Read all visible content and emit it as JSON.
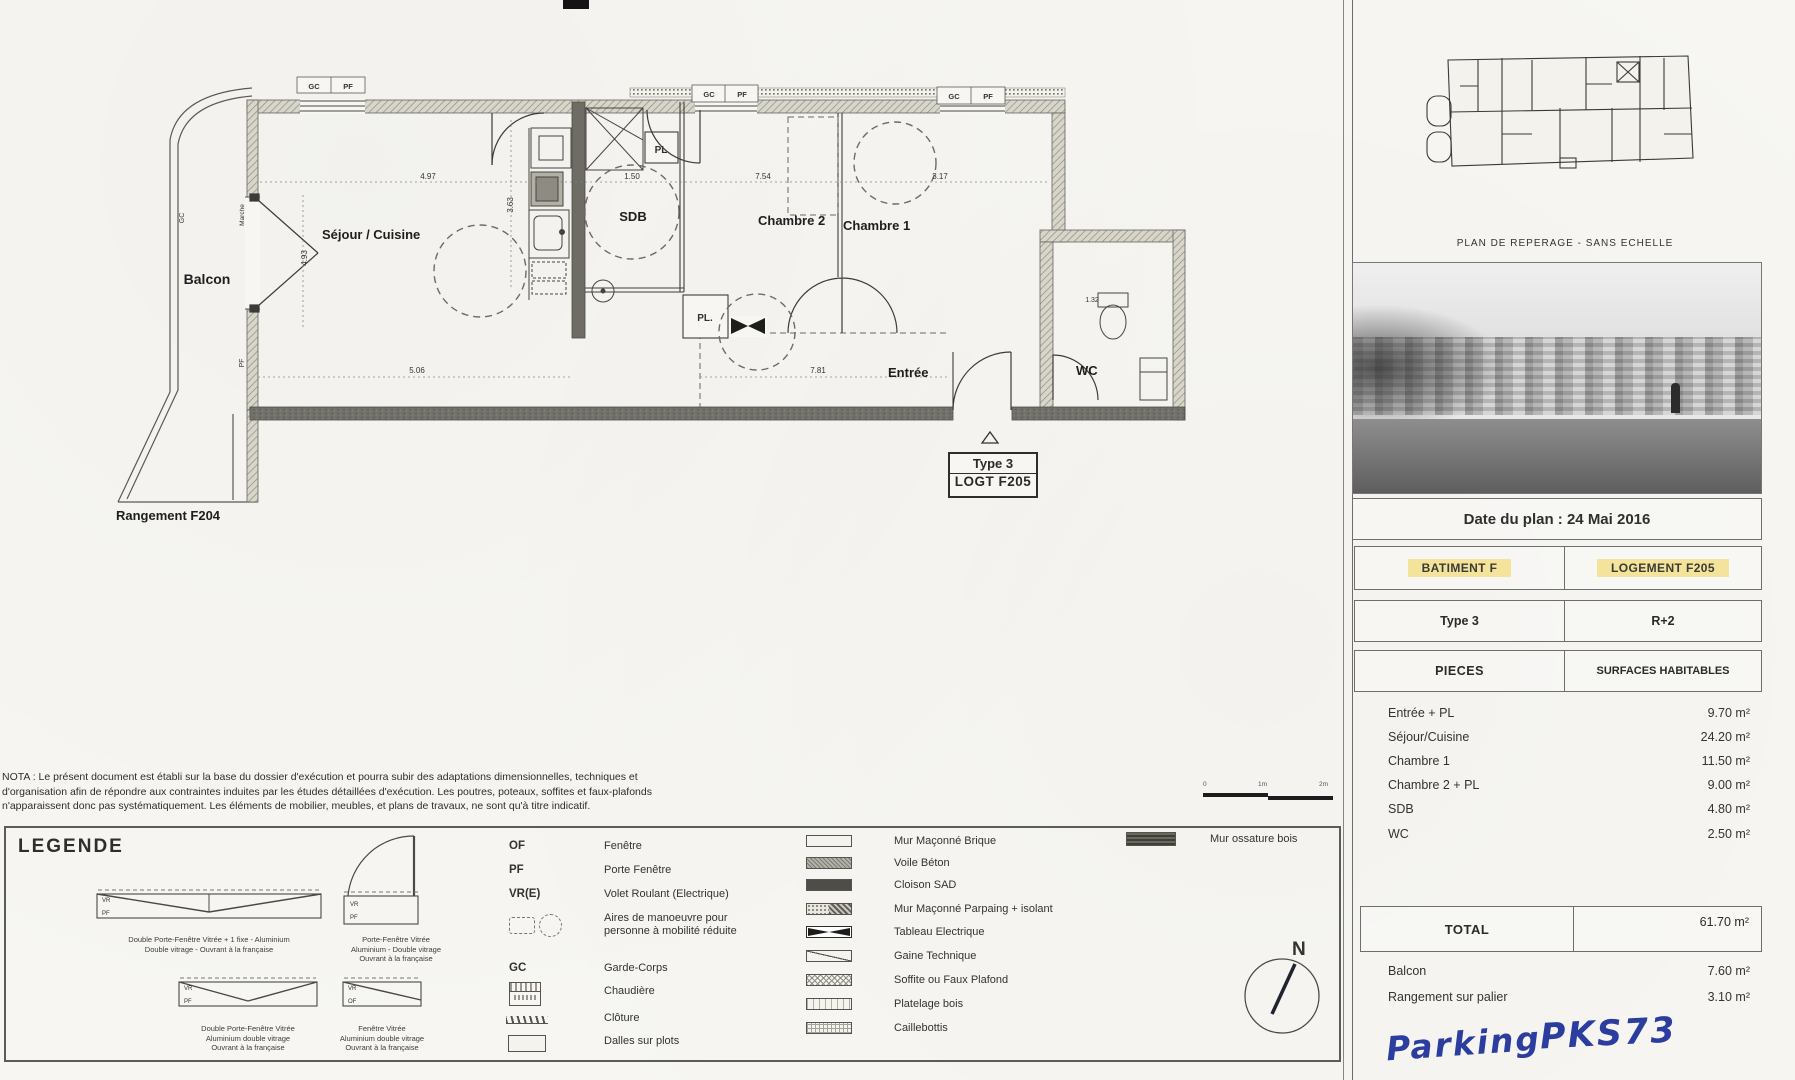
{
  "plan": {
    "labels": {
      "balcon": "Balcon",
      "sejour": "Séjour / Cuisine",
      "sdb": "SDB",
      "chambre2": "Chambre 2",
      "chambre1": "Chambre 1",
      "entree": "Entrée",
      "wc": "WC",
      "rangement": "Rangement F204",
      "pl_top": "PL",
      "pl_bottom": "PL.",
      "marche": "Marche",
      "gc_balcony": "GC",
      "pf_balcony": "PF"
    },
    "tag": {
      "type": "Type 3",
      "logt": "LOGT F205"
    },
    "window_labels": {
      "gc": "GC",
      "pf": "PF"
    },
    "dims": {
      "d_497": "4.97",
      "d_150": "1.50",
      "d_754": "7.54",
      "d_317": "3.17",
      "d_493": "4.93",
      "d_363": "3.63",
      "d_506": "5.06",
      "d_781": "7.81",
      "d_132": "1.32"
    }
  },
  "key_plan": {
    "caption": "PLAN DE REPERAGE - SANS ECHELLE"
  },
  "info": {
    "date": "Date du plan : 24 Mai 2016",
    "batiment": "BATIMENT F",
    "logement": "LOGEMENT F205",
    "type": "Type 3",
    "niveau": "R+2",
    "col_pieces": "PIECES",
    "col_surfaces": "SURFACES HABITABLES",
    "rows": [
      {
        "label": "Entrée + PL",
        "value": "9.70 m²"
      },
      {
        "label": "Séjour/Cuisine",
        "value": "24.20 m²"
      },
      {
        "label": "Chambre 1",
        "value": "11.50 m²"
      },
      {
        "label": "Chambre 2 + PL",
        "value": "9.00 m²"
      },
      {
        "label": "SDB",
        "value": "4.80 m²"
      },
      {
        "label": "WC",
        "value": "2.50 m²"
      }
    ],
    "total_label": "TOTAL",
    "total_value": "61.70 m²",
    "annex_rows": [
      {
        "label": "Balcon",
        "value": "7.60 m²"
      },
      {
        "label": "Rangement sur palier",
        "value": "3.10 m²"
      }
    ],
    "handwriting_1": "Parking",
    "handwriting_2": "PKS73",
    "highlight_color": "#f4e49b"
  },
  "nota": {
    "line1": "NOTA : Le présent document est établi sur la base du dossier d'exécution et pourra subir des adaptations dimensionnelles, techniques et",
    "line2": "d'organisation afin de répondre aux contraintes induites par les études détaillées d'exécution. Les poutres, poteaux, soffites et faux-plafonds",
    "line3": "n'apparaissent donc pas systématiquement. Les éléments de mobilier, meubles, et plans de travaux, ne sont qu'à titre indicatif."
  },
  "legend": {
    "title": "LEGENDE",
    "windows": [
      {
        "tag_top": "VR",
        "tag_bottom": "PF",
        "l1": "Double Porte-Fenêtre Vitrée + 1 fixe - Aluminium",
        "l2": "Double vitrage - Ouvrant à la française",
        "l3": ""
      },
      {
        "tag_top": "VR",
        "tag_bottom": "PF",
        "l1": "Porte-Fenêtre Vitrée",
        "l2": "Aluminium - Double vitrage",
        "l3": "Ouvrant à la française"
      },
      {
        "tag_top": "VR",
        "tag_bottom": "PF",
        "l1": "Double Porte-Fenêtre Vitrée",
        "l2": "Aluminium double vitrage",
        "l3": "Ouvrant à la française"
      },
      {
        "tag_top": "VR",
        "tag_bottom": "OF",
        "l1": "Fenêtre Vitrée",
        "l2": "Aluminium double vitrage",
        "l3": "Ouvrant à la française"
      }
    ],
    "codes": [
      {
        "code": "OF",
        "label": "Fenêtre"
      },
      {
        "code": "PF",
        "label": "Porte Fenêtre"
      },
      {
        "code": "VR(E)",
        "label": "Volet Roulant (Electrique)"
      },
      {
        "code": "",
        "label": "Aires de manoeuvre pour personne à mobilité réduite"
      },
      {
        "code": "GC",
        "label": "Garde-Corps"
      },
      {
        "code": "",
        "label": "Chaudière"
      },
      {
        "code": "",
        "label": "Clôture"
      },
      {
        "code": "",
        "label": "Dalles sur plots"
      }
    ],
    "materials": [
      {
        "label": "Mur Maçonné Brique"
      },
      {
        "label": "Voile Béton"
      },
      {
        "label": "Cloison SAD"
      },
      {
        "label": "Mur Maçonné Parpaing + isolant"
      },
      {
        "label": "Tableau Electrique"
      },
      {
        "label": "Gaine Technique"
      },
      {
        "label": "Soffite ou Faux Plafond"
      },
      {
        "label": "Platelage bois"
      },
      {
        "label": "Caillebottis"
      }
    ],
    "ossature": "Mur ossature bois",
    "compass": "N",
    "scale": {
      "t0": "0",
      "t1": "1m",
      "t2": "2m"
    }
  }
}
